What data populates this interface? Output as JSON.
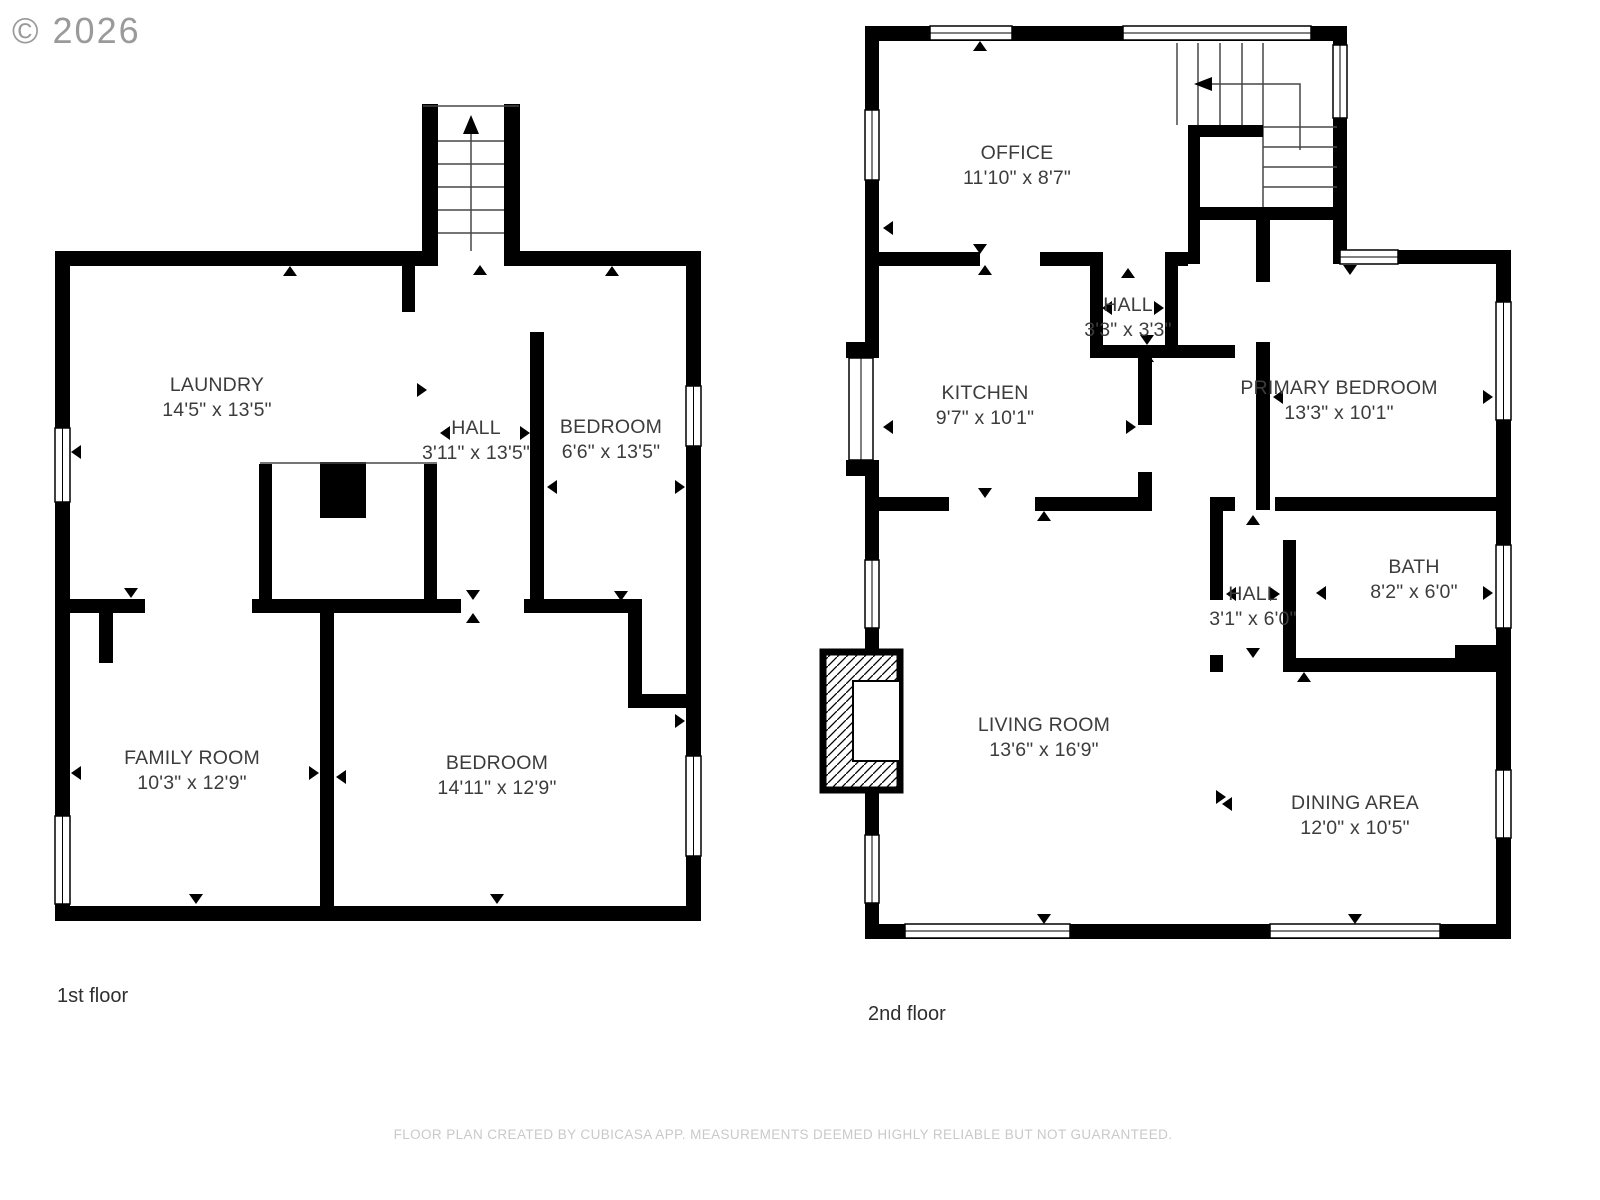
{
  "watermark": "© 2026",
  "floors": [
    {
      "label": "1st floor",
      "rooms": [
        {
          "name": "LAUNDRY",
          "dims": "14'5\" x 13'5\""
        },
        {
          "name": "HALL",
          "dims": "3'11\" x 13'5\""
        },
        {
          "name": "BEDROOM",
          "dims": "6'6\" x 13'5\""
        },
        {
          "name": "FAMILY ROOM",
          "dims": "10'3\" x 12'9\""
        },
        {
          "name": "BEDROOM",
          "dims": "14'11\" x 12'9\""
        }
      ]
    },
    {
      "label": "2nd floor",
      "rooms": [
        {
          "name": "OFFICE",
          "dims": "11'10\" x 8'7\""
        },
        {
          "name": "HALL",
          "dims": "3'3\" x 3'3\""
        },
        {
          "name": "KITCHEN",
          "dims": "9'7\" x 10'1\""
        },
        {
          "name": "PRIMARY BEDROOM",
          "dims": "13'3\" x 10'1\""
        },
        {
          "name": "HALL",
          "dims": "3'1\" x 6'0\""
        },
        {
          "name": "BATH",
          "dims": "8'2\" x 6'0\""
        },
        {
          "name": "LIVING ROOM",
          "dims": "13'6\" x 16'9\""
        },
        {
          "name": "DINING AREA",
          "dims": "12'0\" x 10'5\""
        }
      ]
    }
  ],
  "footer": "FLOOR PLAN CREATED BY CUBICASA APP. MEASUREMENTS DEEMED HIGHLY RELIABLE BUT NOT GUARANTEED.",
  "colors": {
    "wall": "#000000",
    "room_text": "#3c3c3c",
    "floor_label_text": "#2f2f2f",
    "footer_text": "#c9c9c9",
    "watermark_text": "#9a9a9a"
  }
}
